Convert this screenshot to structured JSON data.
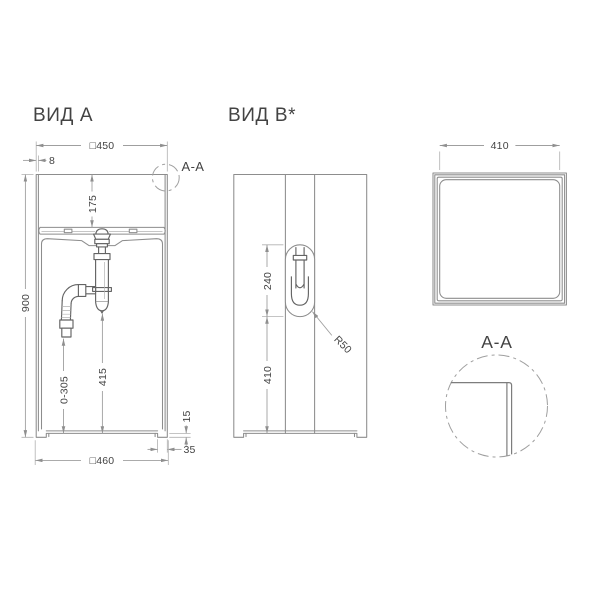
{
  "colors": {
    "background": "#ffffff",
    "body_line": "#8d8d8d",
    "plumbing_line": "#646464",
    "dimension_line": "#9f9f9f",
    "text": "#434343"
  },
  "view_a": {
    "title": "ВИД A",
    "section_marker": "A-A",
    "dims": {
      "top_width": "□450",
      "rim_thickness": "8",
      "bowl_depth": "175",
      "total_height": "900",
      "trap_clearance": "415",
      "outlet_range": "0-305",
      "foot_height": "15",
      "foot_inset": "35",
      "base_width": "□460"
    }
  },
  "view_b": {
    "title": "ВИД B*",
    "dims": {
      "slot_height": "240",
      "slot_to_base": "410",
      "slot_radius": "R50"
    }
  },
  "top_view": {
    "dims": {
      "opening_width": "410"
    }
  },
  "section_detail": {
    "title": "A-A"
  }
}
